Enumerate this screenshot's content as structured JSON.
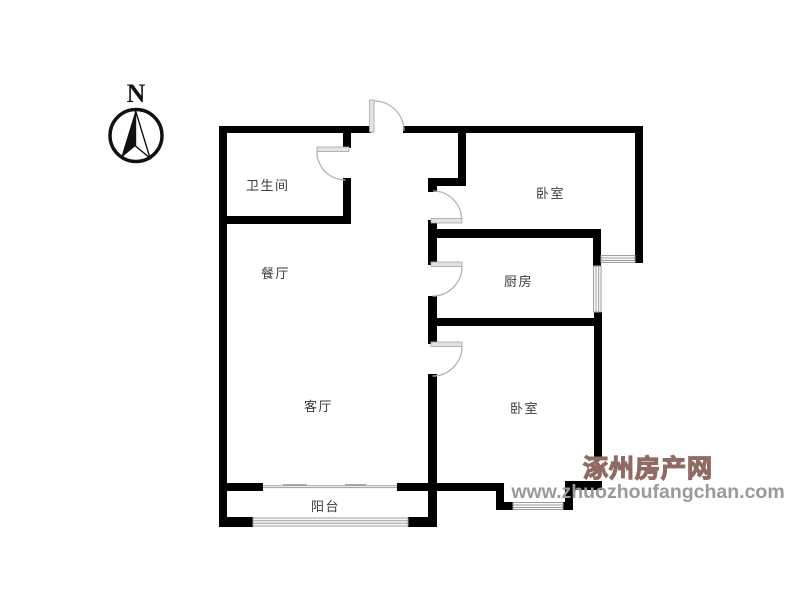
{
  "compass": {
    "label": "N"
  },
  "rooms": [
    {
      "id": "bathroom",
      "label": "卫生间"
    },
    {
      "id": "dining-room",
      "label": "餐厅"
    },
    {
      "id": "bedroom-north",
      "label": "卧室"
    },
    {
      "id": "kitchen",
      "label": "厨房"
    },
    {
      "id": "living-room",
      "label": "客厅"
    },
    {
      "id": "bedroom-south",
      "label": "卧室"
    },
    {
      "id": "balcony",
      "label": "阳台"
    }
  ],
  "watermark": {
    "site_name": "涿州房产网",
    "site_url": "www.zhuozhoufangchan.com"
  },
  "colors": {
    "wall": "#000000",
    "door": "#b3b3b3",
    "door_leaf_fill": "#e3e3e3",
    "window_frame": "#9e9e9e",
    "window_fill": "#fafafa",
    "label_text": "#3b3b3b",
    "watermark_name_fill": "#ffffff",
    "watermark_name_outline": "#8f6b63",
    "watermark_url_text": "#9e9896"
  }
}
